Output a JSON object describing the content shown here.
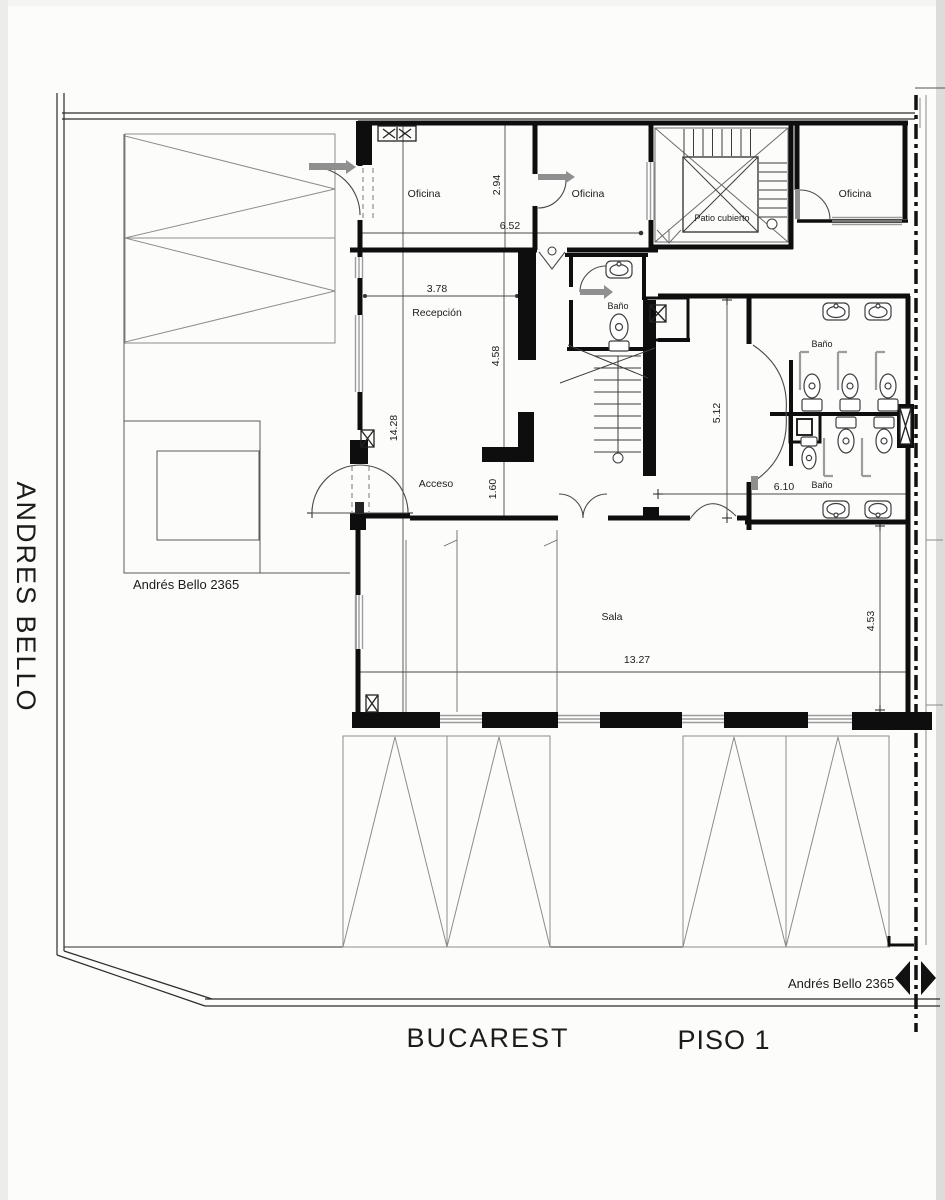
{
  "plan": {
    "title": "PISO 1",
    "streets": {
      "left": "ANDRES BELLO",
      "bottom": "BUCAREST"
    },
    "addresses": {
      "left": "Andrés Bello 2365",
      "right": "Andrés Bello 2365"
    },
    "rooms": {
      "oficina_left": "Oficina",
      "oficina_mid": "Oficina",
      "oficina_right": "Oficina",
      "patio": "Patio cubierto",
      "bano_hall": "Baño",
      "bano_top": "Baño",
      "bano_bottom": "Baño",
      "recepcion": "Recepción",
      "acceso": "Acceso",
      "sala": "Sala"
    },
    "dimensions": {
      "oficina_depth": "2.94",
      "oficinas_width": "6.52",
      "recepcion_width": "3.78",
      "recepcion_depth": "4.58",
      "building_depth": "14.28",
      "entry_step": "1.60",
      "bath_depth": "5.12",
      "bath_width": "6.10",
      "sala_width": "13.27",
      "sala_depth": "4.53"
    },
    "colors": {
      "wall": "#0e0e0e",
      "line": "#3c3c3c",
      "light_gray": "#a0a0a0",
      "paper": "#fcfcfa"
    }
  }
}
